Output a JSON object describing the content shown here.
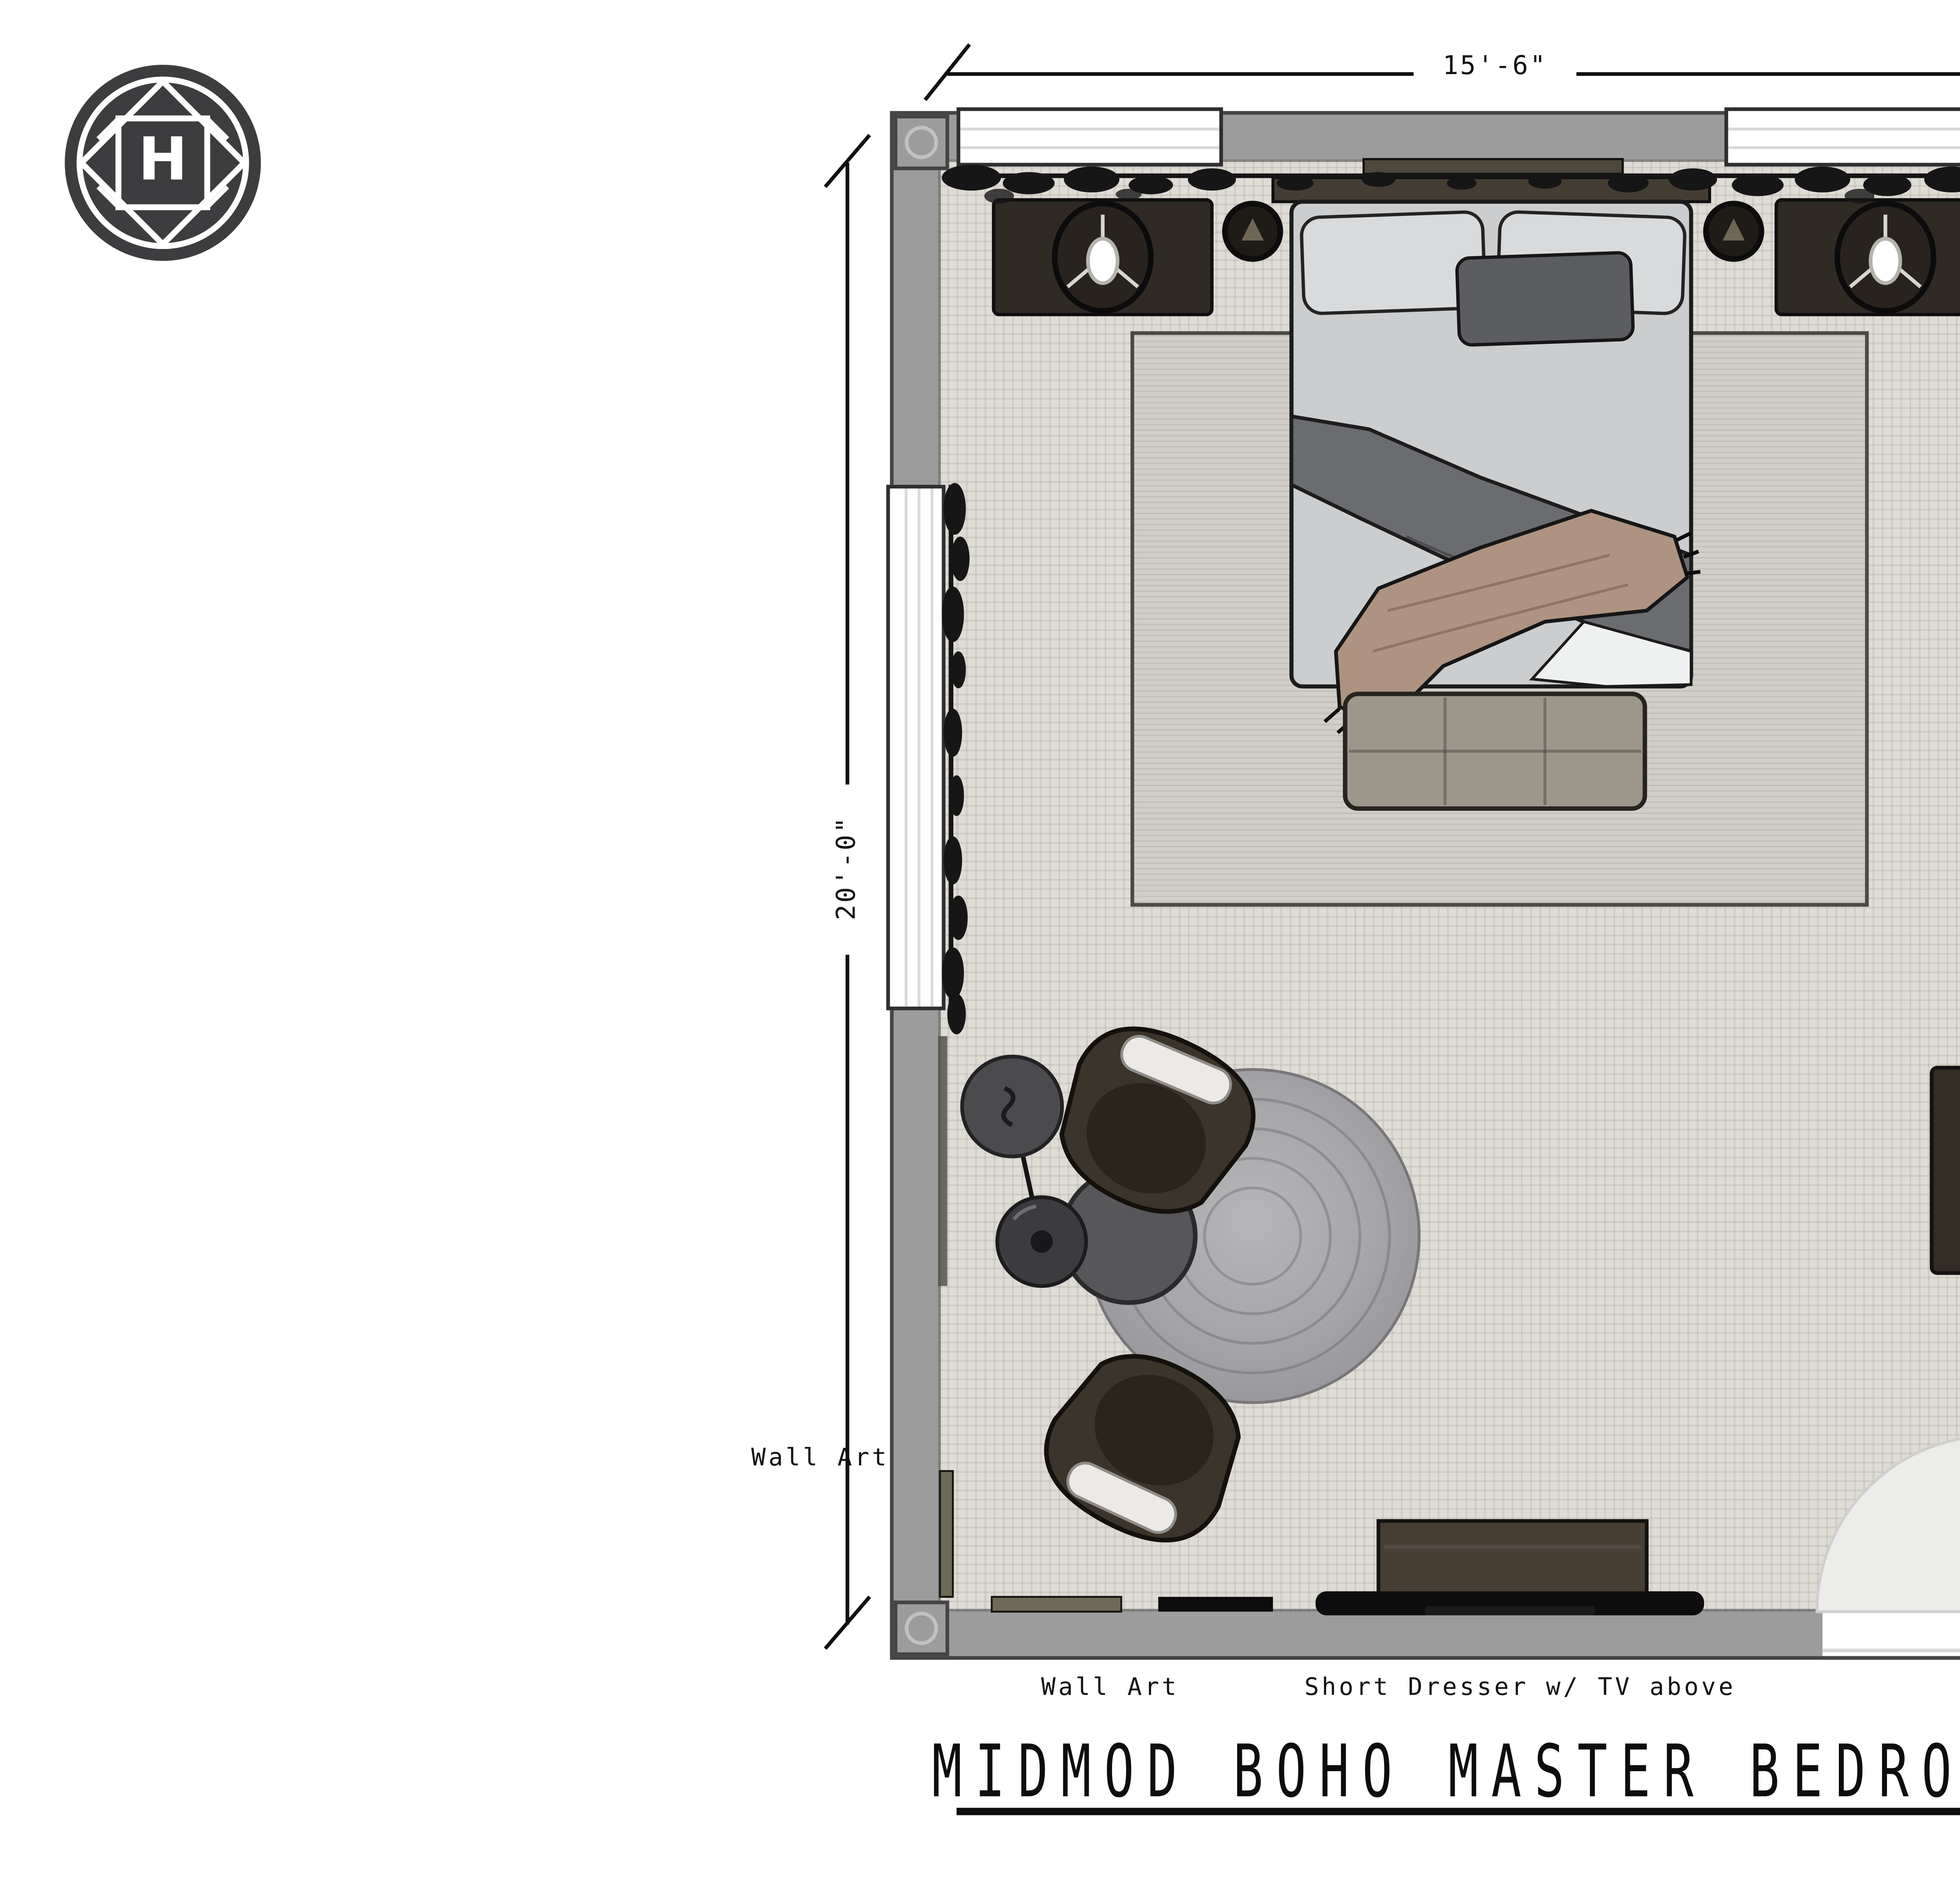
{
  "logo": {
    "letter": "H",
    "icon": "h-monogram-circle-icon"
  },
  "dimensions": {
    "width_label": "15'-6\"",
    "height_label": "20'-0\""
  },
  "annotations": {
    "ladder": "Ladder",
    "tall_dresser_line1": "Tall Dresser w/ Art",
    "tall_dresser_line2": "& Mirror Above",
    "wall_art_left": "Wall Art",
    "wall_art_bottom": "Wall Art",
    "short_dresser": "Short Dresser w/ TV above"
  },
  "title": {
    "text": "MIDMOD BOHO MASTER BEDROOM",
    "underlined": true
  },
  "palette": {
    "wall_gray": "#9c9c9c",
    "wall_edge": "#454545",
    "floor": "#dfdcd6",
    "area_rug": "#d2cfc9",
    "round_rug": "#a6a6a9",
    "dark_wood": "#322c25",
    "bench_taupe": "#9d968b",
    "chair_olive": "#3b342a",
    "duvet_gray": "#6a6c6f",
    "throw_tan": "#ad9380",
    "text": "#111111"
  }
}
